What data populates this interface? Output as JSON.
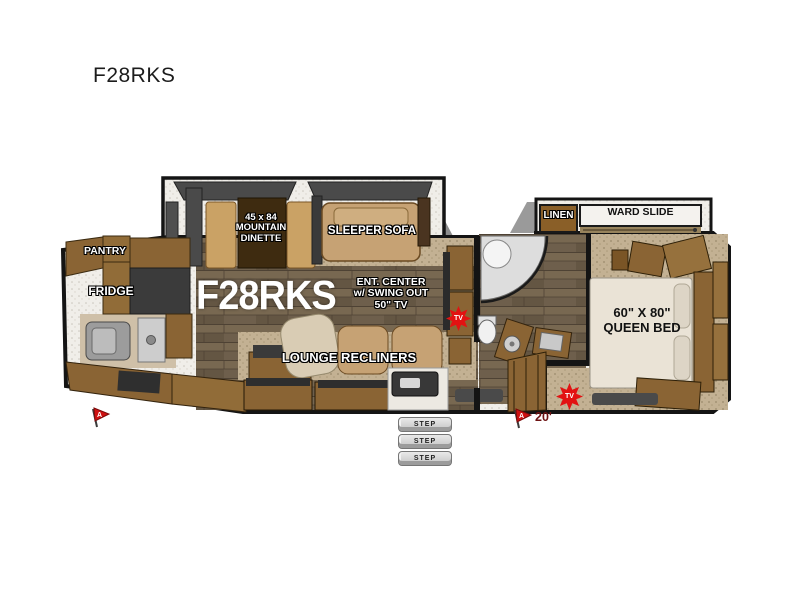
{
  "page": {
    "heading": "F28RKS"
  },
  "plan": {
    "model": "F28RKS",
    "labels": {
      "pantry": "PANTRY",
      "fridge": "FRIDGE",
      "dinette_line1": "45 x 84",
      "dinette_line2": "MOUNTAIN",
      "dinette_line3": "DINETTE",
      "sleeper_sofa": "SLEEPER SOFA",
      "ent_line1": "ENT. CENTER",
      "ent_line2": "w/ SWING OUT",
      "ent_line3": "50\" TV",
      "lounge_recliners": "LOUNGE RECLINERS",
      "linen": "LINEN",
      "ward_slide": "WARD SLIDE",
      "bed_line1": "60\" X 80\"",
      "bed_line2": "QUEEN BED"
    },
    "steps": [
      "STEP",
      "STEP",
      "STEP"
    ],
    "tv_badges": [
      "TV",
      "TV"
    ],
    "awning": {
      "length": "20'",
      "flag_mark": "A"
    },
    "colors": {
      "outline": "#141414",
      "cabinet": "#8a6434",
      "upholstery": "#c6a274",
      "badge_red": "#e21212"
    }
  }
}
